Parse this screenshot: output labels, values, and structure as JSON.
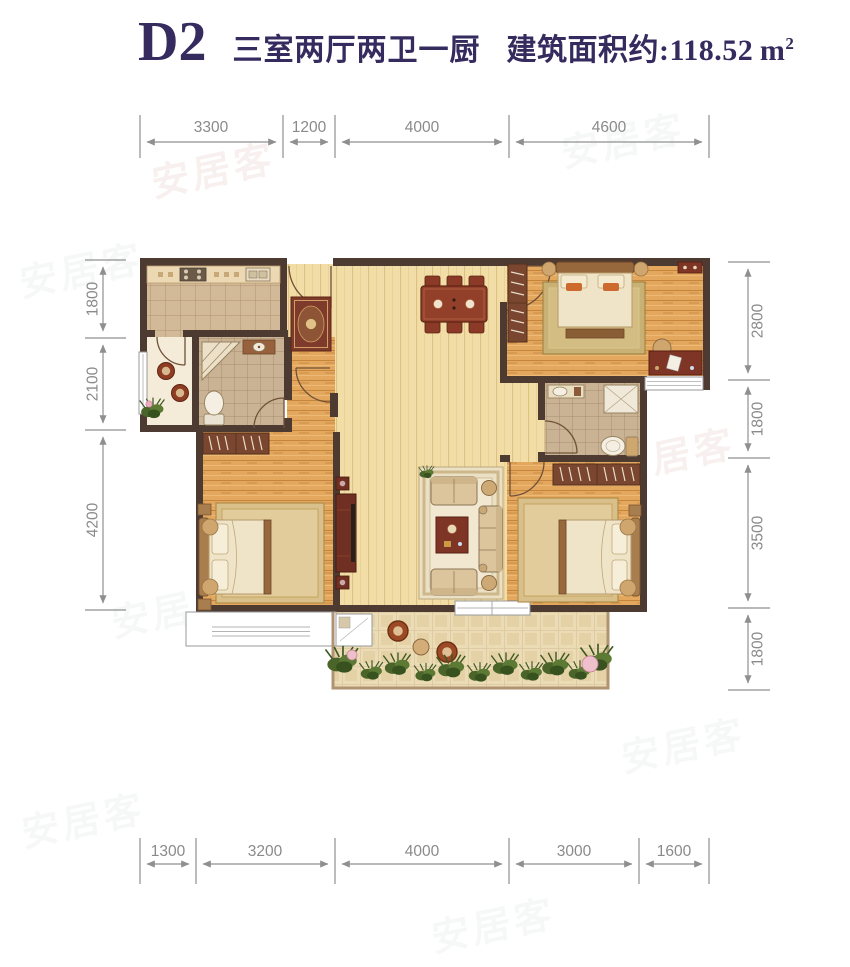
{
  "header": {
    "unit_code": "D2",
    "layout_desc": "三室两厅两卫一厨",
    "area_label": "建筑面积约:",
    "area_value": "118.52",
    "area_unit_base": "m",
    "area_unit_exp": "2"
  },
  "dimensions": {
    "top": [
      "3300",
      "1200",
      "4000",
      "4600"
    ],
    "bottom": [
      "1300",
      "3200",
      "4000",
      "3000",
      "1600"
    ],
    "left": [
      "1800",
      "2100",
      "4200"
    ],
    "right": [
      "2800",
      "1800",
      "3500",
      "1800"
    ]
  },
  "watermark": {
    "text": "安居客"
  },
  "colors": {
    "title": "#362b5e",
    "wall": "#4d3b32",
    "dimension_gray": "#8f8f8f",
    "wood_light": "#f1dda5",
    "wood_orange": "#e4a75e",
    "furniture_red": "#7e3526"
  }
}
